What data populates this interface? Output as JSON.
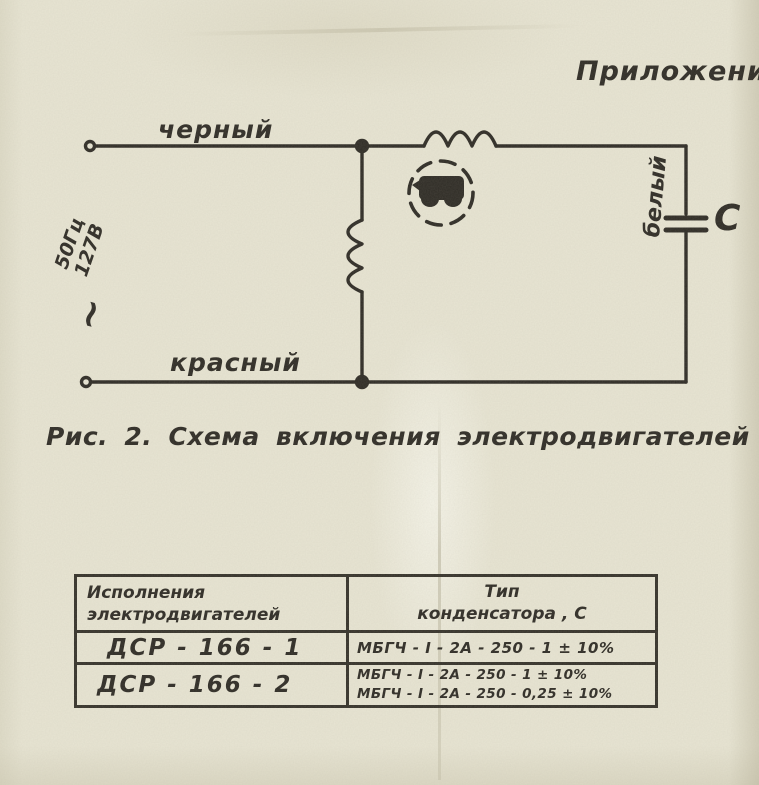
{
  "page": {
    "appendix_label": "Приложение",
    "figure_caption": "Рис. 2. Схема  включения  электродвигателей"
  },
  "schematic": {
    "top_wire_label": "черный",
    "bottom_wire_label": "красный",
    "right_wire_label": "белый",
    "source_frequency": "50Гц",
    "source_voltage": "127В",
    "ac_symbol": "~",
    "capacitor_label": "C"
  },
  "table": {
    "col1_header_line1": "Исполнения",
    "col1_header_line2": "электродвигателей",
    "col2_header_line1": "Тип",
    "col2_header_line2": "конденсатора , С",
    "rows": [
      {
        "motor": "ДСР - 166 - 1",
        "capacitor_line1": "МБГЧ - I - 2А - 250 - 1 ± 10%"
      },
      {
        "motor": "ДСР - 166 - 2",
        "capacitor_line1": "МБГЧ - I - 2А - 250 - 1 ± 10%",
        "capacitor_line2": "МБГЧ - I - 2А - 250 - 0,25 ± 10%"
      }
    ]
  },
  "colors": {
    "paper": "#e8e5d3",
    "ink": "#2e2b25"
  }
}
